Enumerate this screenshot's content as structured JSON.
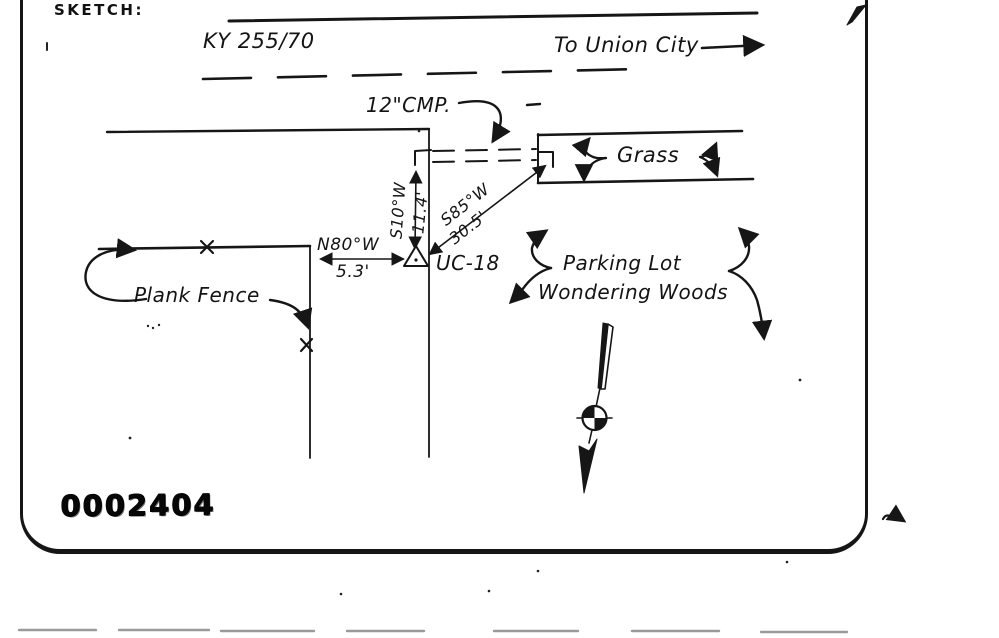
{
  "page": {
    "title_label": "SKETCH:",
    "stamp_number": "0002404",
    "ink_color": "#161616",
    "paper_color": "#ffffff",
    "divider_color": "#9a9a9a"
  },
  "road": {
    "route": "KY 255/70",
    "direction_note": "To Union City"
  },
  "culvert": {
    "label": "12\"CMP."
  },
  "grass": {
    "label": "Grass"
  },
  "survey": {
    "bearing_1": {
      "bearing": "S10°W",
      "distance": "11.4'"
    },
    "bearing_2": {
      "bearing": "S85°W",
      "distance": "30.5'"
    },
    "bearing_3": {
      "bearing": "N80°W",
      "distance": "5.3'"
    },
    "station": "UC-18"
  },
  "features": {
    "fence": "Plank Fence",
    "parking_line1": "Parking Lot",
    "parking_line2": "Wondering Woods"
  }
}
